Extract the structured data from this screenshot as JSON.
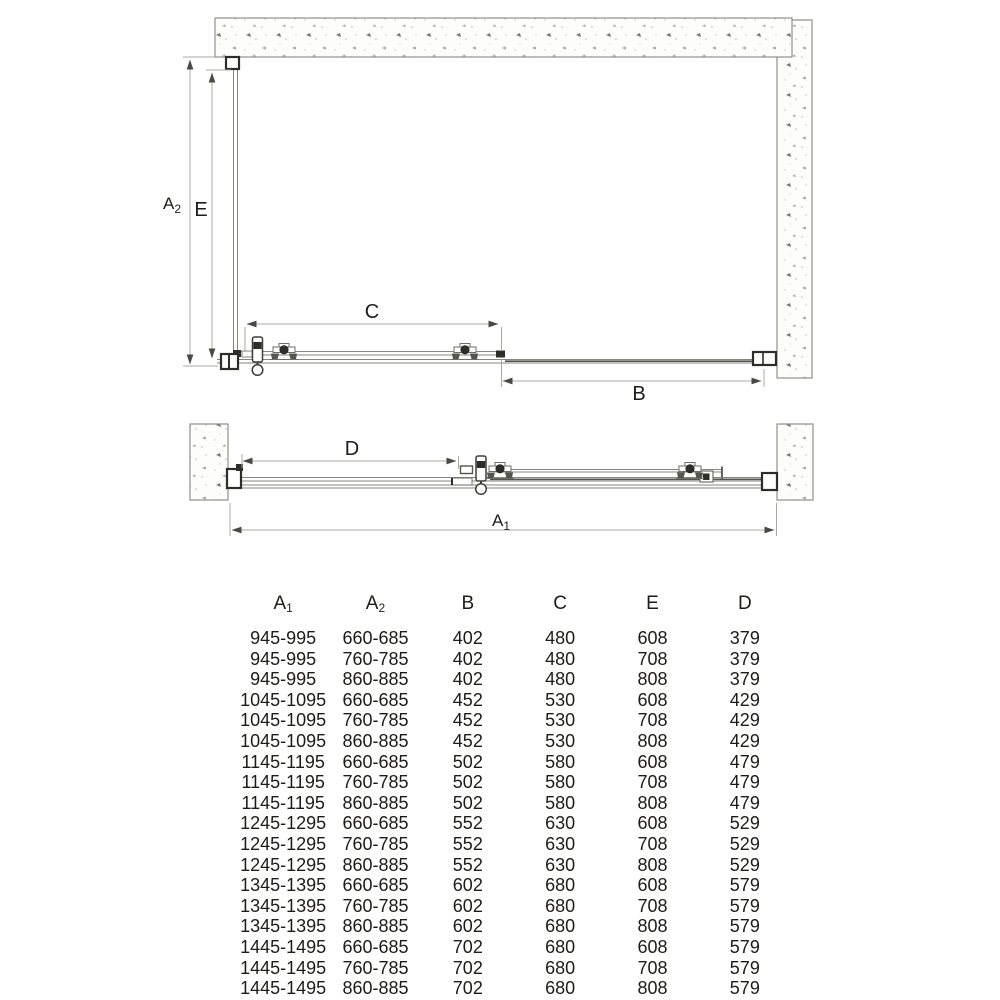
{
  "diagram": {
    "labels": {
      "a2": {
        "base": "A",
        "sub": "2"
      },
      "e": "E",
      "c": "C",
      "b": "B",
      "d": "D",
      "a1": {
        "base": "A",
        "sub": "1"
      }
    }
  },
  "table": {
    "headers": [
      {
        "base": "A",
        "sub": "1"
      },
      {
        "base": "A",
        "sub": "2"
      },
      {
        "base": "B",
        "sub": ""
      },
      {
        "base": "C",
        "sub": ""
      },
      {
        "base": "E",
        "sub": ""
      },
      {
        "base": "D",
        "sub": ""
      }
    ],
    "rows": [
      [
        "945-995",
        "660-685",
        "402",
        "480",
        "608",
        "379"
      ],
      [
        "945-995",
        "760-785",
        "402",
        "480",
        "708",
        "379"
      ],
      [
        "945-995",
        "860-885",
        "402",
        "480",
        "808",
        "379"
      ],
      [
        "1045-1095",
        "660-685",
        "452",
        "530",
        "608",
        "429"
      ],
      [
        "1045-1095",
        "760-785",
        "452",
        "530",
        "708",
        "429"
      ],
      [
        "1045-1095",
        "860-885",
        "452",
        "530",
        "808",
        "429"
      ],
      [
        "1145-1195",
        "660-685",
        "502",
        "580",
        "608",
        "479"
      ],
      [
        "1145-1195",
        "760-785",
        "502",
        "580",
        "708",
        "479"
      ],
      [
        "1145-1195",
        "860-885",
        "502",
        "580",
        "808",
        "479"
      ],
      [
        "1245-1295",
        "660-685",
        "552",
        "630",
        "608",
        "529"
      ],
      [
        "1245-1295",
        "760-785",
        "552",
        "630",
        "708",
        "529"
      ],
      [
        "1245-1295",
        "860-885",
        "552",
        "630",
        "808",
        "529"
      ],
      [
        "1345-1395",
        "660-685",
        "602",
        "680",
        "608",
        "579"
      ],
      [
        "1345-1395",
        "760-785",
        "602",
        "680",
        "708",
        "579"
      ],
      [
        "1345-1395",
        "860-885",
        "602",
        "680",
        "808",
        "579"
      ],
      [
        "1445-1495",
        "660-685",
        "702",
        "680",
        "608",
        "579"
      ],
      [
        "1445-1495",
        "760-785",
        "702",
        "680",
        "708",
        "579"
      ],
      [
        "1445-1495",
        "860-885",
        "702",
        "680",
        "808",
        "579"
      ]
    ]
  },
  "colors": {
    "text": "#1e1c18",
    "dimension_line": "#a9a9a3",
    "drawing_line": "#85857f",
    "hardware": "#2e2e29",
    "wall_border": "#90908a",
    "arrow": "#4a4a44"
  }
}
